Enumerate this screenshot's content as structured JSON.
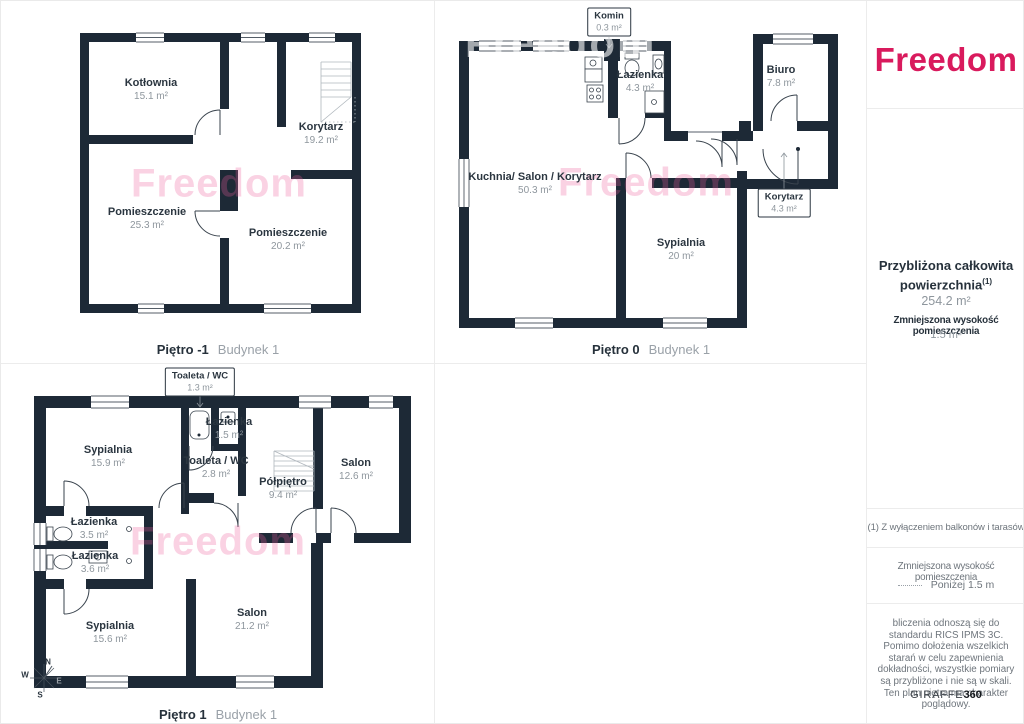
{
  "colors": {
    "wall": "#1d2936",
    "brand_pink": "#d91a5d",
    "watermark_pink": "#ec5f9c",
    "room_name_text": "#2b3640",
    "area_text": "#8e969d"
  },
  "brand": {
    "logo": "Freedom"
  },
  "plans": [
    {
      "floor": "Piętro -1",
      "building": "Budynek 1",
      "watermark": "Freedom",
      "rooms": [
        {
          "name": "Kotłownia",
          "area": "15.1 m²"
        },
        {
          "name": "Korytarz",
          "area": "19.2 m²"
        },
        {
          "name": "Pomieszczenie",
          "area": "25.3 m²"
        },
        {
          "name": "Pomieszczenie",
          "area": "20.2 m²"
        }
      ]
    },
    {
      "floor": "Piętro 0",
      "building": "Budynek 1",
      "watermark": "Freedom",
      "rooms": [
        {
          "name": "Komin",
          "area": "0.3 m²"
        },
        {
          "name": "Łazienka",
          "area": "4.3 m²"
        },
        {
          "name": "Biuro",
          "area": "7.8 m²"
        },
        {
          "name": "Kuchnia/ Salon / Korytarz",
          "area": "50.3 m²"
        },
        {
          "name": "Sypialnia",
          "area": "20 m²"
        },
        {
          "name": "Korytarz",
          "area": "4.3 m²"
        }
      ]
    },
    {
      "floor": "Piętro 1",
      "building": "Budynek 1",
      "watermark": "Freedom",
      "rooms": [
        {
          "name": "Toaleta / WC",
          "area": "1.3 m²"
        },
        {
          "name": "Sypialnia",
          "area": "15.9 m²"
        },
        {
          "name": "Łazienka",
          "area": "1.5 m²"
        },
        {
          "name": "Toaleta / WC",
          "area": "2.8 m²"
        },
        {
          "name": "Półpiętro",
          "area": "9.4 m²"
        },
        {
          "name": "Salon",
          "area": "12.6 m²"
        },
        {
          "name": "Łazienka",
          "area": "3.5 m²"
        },
        {
          "name": "Łazienka",
          "area": "3.6 m²"
        },
        {
          "name": "Sypialnia",
          "area": "15.6 m²"
        },
        {
          "name": "Salon",
          "area": "21.2 m²"
        }
      ],
      "compass": {
        "n": "N",
        "e": "E",
        "s": "S",
        "w": "W"
      }
    }
  ],
  "sidebar": {
    "total_label_line1": "Przybliżona całkowita",
    "total_label_line2": "powierzchnia",
    "total_footnote_marker": "(1)",
    "total_value": "254.2 m²",
    "reduced_height_label": "Zmniejszona wysokość pomieszczenia",
    "reduced_height_value": "1.5 m²",
    "footnote": "(1) Z wyłączeniem balkonów i tarasów",
    "legend_label": "Zmniejszona wysokość pomieszczenia",
    "legend_value": "Poniżej 1.5 m",
    "disclaimer": "bliczenia odnoszą się do standardu RICS IPMS 3C. Pomimo dołożenia wszelkich starań w celu zapewnienia dokładności, wszystkie pomiary są przybliżone i nie są w skali. Ten plan piętra ma charakter poglądowy.",
    "vendor_name": "GIRAFFE",
    "vendor_suffix": "360"
  }
}
